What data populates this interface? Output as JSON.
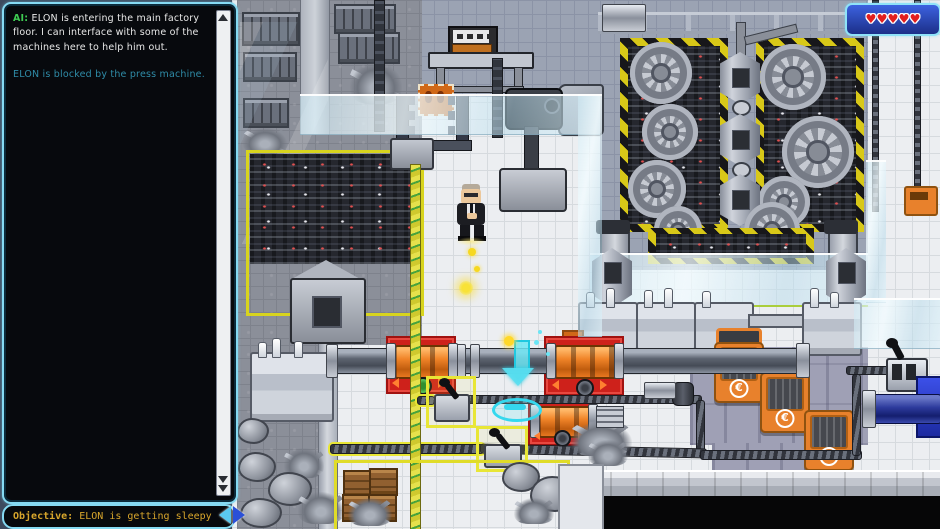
{
  "hud": {
    "log": {
      "messages": [
        {
          "speaker": "AI:",
          "text": " ELON is entering the main factory floor. I can interface with some of the machines here to help him out."
        },
        {
          "speaker": "",
          "text": "ELON is blocked by the press machine."
        }
      ]
    },
    "objective": {
      "label": "Objective:",
      "text": " ELON is getting sleepy"
    },
    "health": {
      "hearts": 5,
      "heart_icon": "♥"
    }
  },
  "scene": {
    "euro_label": "€"
  },
  "colors": {
    "ui_border_cyan": "#85d9f2",
    "panel_bg": "#07090d",
    "frame_bg": "#3d4a5e",
    "heart_red": "#e21f1f",
    "objective_gold": "#d8a62c",
    "ai_green": "#3ecb52",
    "info_teal": "#2f8ca8",
    "hazard_yellow": "#d8c818",
    "pad_red": "#ce211b",
    "machine_orange": "#e8812c",
    "highlight_cyan": "#35d8ee",
    "rope_yellow": "#e6e14c",
    "glass_blue": "#cde9f4",
    "floor_tile": "#eceef1"
  }
}
